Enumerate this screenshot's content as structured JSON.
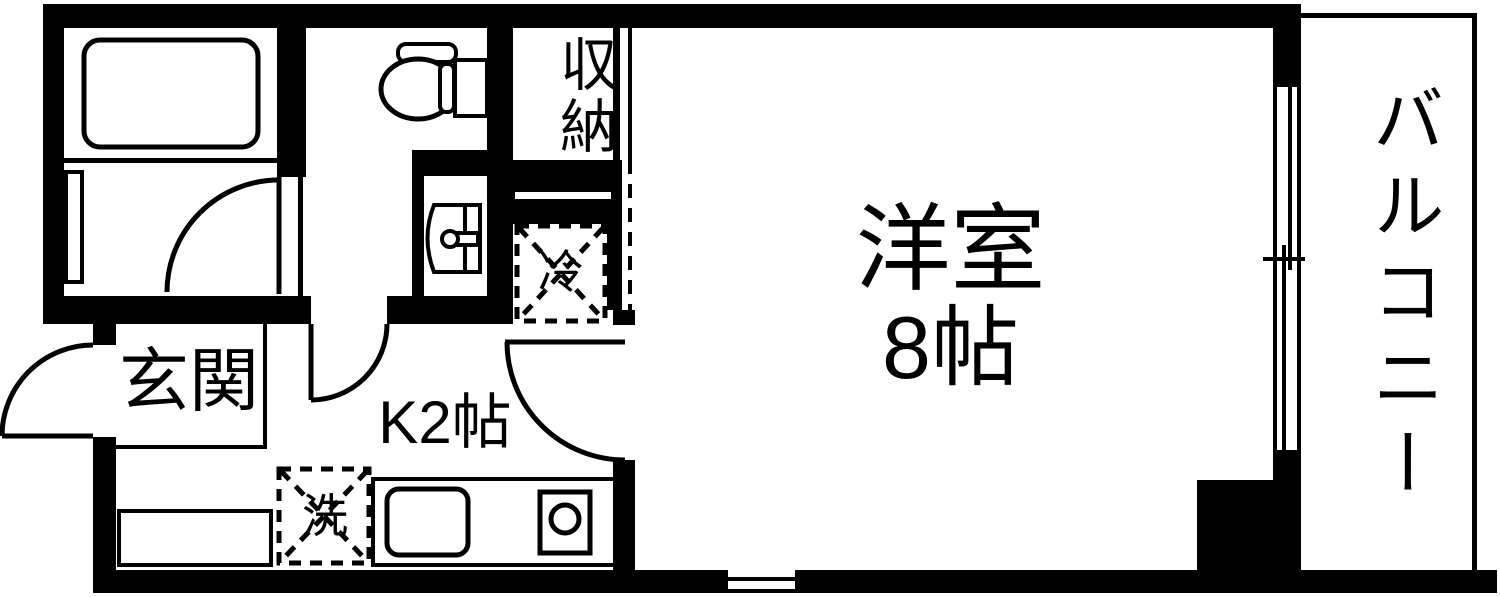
{
  "plan": {
    "title": "1K apartment floor plan",
    "rooms": {
      "entrance_label": "玄関",
      "kitchen_label": "K2帖",
      "main_room_name": "洋室",
      "main_room_size": "8帖",
      "balcony_label": "バルコニー",
      "storage_label": "収納",
      "refrigerator_label": "冷",
      "washer_label": "洗"
    },
    "colors": {
      "wall": "#000000",
      "floor": "#ffffff"
    }
  }
}
